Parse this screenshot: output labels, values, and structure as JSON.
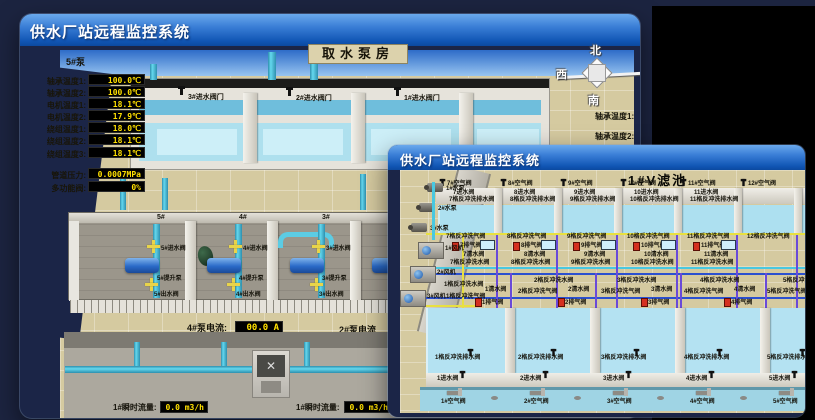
{
  "back_window": {
    "titlebar": "供水厂站远程监控系统",
    "scene_title": "取水泵房",
    "pump_panel": {
      "header": "5#泵",
      "rows": [
        {
          "label": "轴承温度1:",
          "value": "100.0℃"
        },
        {
          "label": "轴承温度2:",
          "value": "100.0℃"
        },
        {
          "label": "电机温度1:",
          "value": "18.1℃"
        },
        {
          "label": "电机温度2:",
          "value": "17.9℃"
        },
        {
          "label": "绕组温度1:",
          "value": "18.0℃"
        },
        {
          "label": "绕组温度2:",
          "value": "18.1℃"
        },
        {
          "label": "绕组温度3:",
          "value": "18.1℃"
        },
        {
          "label": "管道压力:",
          "value": "0.0007MPa"
        },
        {
          "label": "多功能阀:",
          "value": "0%"
        }
      ]
    },
    "intake_valves": [
      {
        "label": "3#进水阀门"
      },
      {
        "label": "2#进水阀门"
      },
      {
        "label": "1#进水阀门"
      }
    ],
    "compass": {
      "north": "北",
      "west": "西",
      "south": "南"
    },
    "side_labels": [
      {
        "label": "轴承温度1:"
      },
      {
        "label": "轴承温度2:"
      }
    ],
    "pump_bays": [
      {
        "num": "5#",
        "inlet": "5#进水阀",
        "pump": "5#提升泵",
        "outlet": "5#出水阀"
      },
      {
        "num": "4#",
        "inlet": "4#进水阀",
        "pump": "4#提升泵",
        "outlet": "4#出水阀"
      },
      {
        "num": "3#",
        "inlet": "3#进水阀",
        "pump": "3#提升泵",
        "outlet": "3#出水阀"
      },
      {
        "num": "2#",
        "inlet": "2#进水阀",
        "pump": "2#提升泵",
        "outlet": "2#出水阀"
      }
    ],
    "current_readout": {
      "label": "4#泵电流:",
      "value": "00.0 A"
    },
    "current_readout_2": {
      "label": "2#泵电流"
    },
    "flow_readouts": [
      {
        "label": "1#瞬时流量:",
        "value": "0.0 m3/h"
      },
      {
        "label": "1#瞬时流量:",
        "value": "0.0 m3/h"
      }
    ]
  },
  "front_window": {
    "titlebar": "供水厂站远程监控系统",
    "scene_title": "1#V滤池",
    "equipment": [
      {
        "label": "1#水泵",
        "type": "pump"
      },
      {
        "label": "2#水泵",
        "type": "pump"
      },
      {
        "label": "3#水泵",
        "type": "pump"
      },
      {
        "label": "1#风机",
        "type": "fan"
      },
      {
        "label": "2#风机",
        "type": "fan"
      },
      {
        "label": "3#风机",
        "type": "fan"
      }
    ],
    "top_cells": [
      {
        "air": "7#空气阀",
        "inlet": "7进水阀",
        "drain": "7格反冲洗排水阀",
        "bw_air": "7格反冲洗气阀",
        "exhaust": "7排气阀",
        "clean": "7清水阀",
        "bw_water": "7格反冲洗水阀"
      },
      {
        "air": "8#空气阀",
        "inlet": "8进水阀",
        "drain": "8格反冲洗排水阀",
        "bw_air": "8格反冲洗气阀",
        "exhaust": "8排气阀",
        "clean": "8清水阀",
        "bw_water": "8格反冲洗水阀"
      },
      {
        "air": "9#空气阀",
        "inlet": "9进水阀",
        "drain": "9格反冲洗排水阀",
        "bw_air": "9格反冲洗气阀",
        "exhaust": "9排气阀",
        "clean": "9清水阀",
        "bw_water": "9格反冲洗水阀"
      },
      {
        "air": "10#空气阀",
        "inlet": "10进水阀",
        "drain": "10格反冲洗排水阀",
        "bw_air": "10格反冲洗气阀",
        "exhaust": "10排气阀",
        "clean": "10清水阀",
        "bw_water": "10格反冲洗水阀"
      },
      {
        "air": "11#空气阀",
        "inlet": "11进水阀",
        "drain": "11格反冲洗排水阀",
        "bw_air": "11格反冲洗气阀",
        "exhaust": "11排气阀",
        "clean": "11清水阀",
        "bw_water": "11格反冲洗水阀"
      },
      {
        "air": "12#空气阀",
        "inlet": "",
        "drain": "",
        "bw_air": "12格反冲洗气阀",
        "exhaust": "",
        "clean": "",
        "bw_water": ""
      }
    ],
    "bottom_cells": [
      {
        "bw_water": "1格反冲洗水阀",
        "bw_air": "1格反冲洗气阀",
        "clean": "1清水阀",
        "exhaust": "1排气阀",
        "drain": "1格反冲洗排水阀",
        "inlet": "1进水阀",
        "air": "1#空气阀"
      },
      {
        "bw_water": "2格反冲洗水阀",
        "bw_air": "2格反冲洗气阀",
        "clean": "2清水阀",
        "exhaust": "2排气阀",
        "drain": "2格反冲洗排水阀",
        "inlet": "2进水阀",
        "air": "2#空气阀"
      },
      {
        "bw_water": "3格反冲洗水阀",
        "bw_air": "3格反冲洗气阀",
        "clean": "3清水阀",
        "exhaust": "3排气阀",
        "drain": "3格反冲洗排水阀",
        "inlet": "3进水阀",
        "air": "3#空气阀"
      },
      {
        "bw_water": "4格反冲洗水阀",
        "bw_air": "4格反冲洗气阀",
        "clean": "4清水阀",
        "exhaust": "4排气阀",
        "drain": "4格反冲洗排水阀",
        "inlet": "4进水阀",
        "air": "4#空气阀"
      },
      {
        "bw_water": "5格反冲洗水阀",
        "bw_air": "5格反冲洗气阀",
        "clean": "5清水阀",
        "exhaust": "5排气阀",
        "drain": "5格反冲洗排水阀",
        "inlet": "5进水阀",
        "air": "5#空气阀"
      }
    ]
  },
  "colors": {
    "titlebar_top": "#6aa9ec",
    "titlebar_bottom": "#0c49a0",
    "lcd_text": "#FFE000",
    "ground": "#D5CAA0",
    "water": "#ADE0F0",
    "sky": "#4f94e4",
    "pipe_cyan": "#64d8ee",
    "valve_yellow": "#E8D44A",
    "exhaust_red": "#D43020",
    "backdrop": "#000000"
  }
}
